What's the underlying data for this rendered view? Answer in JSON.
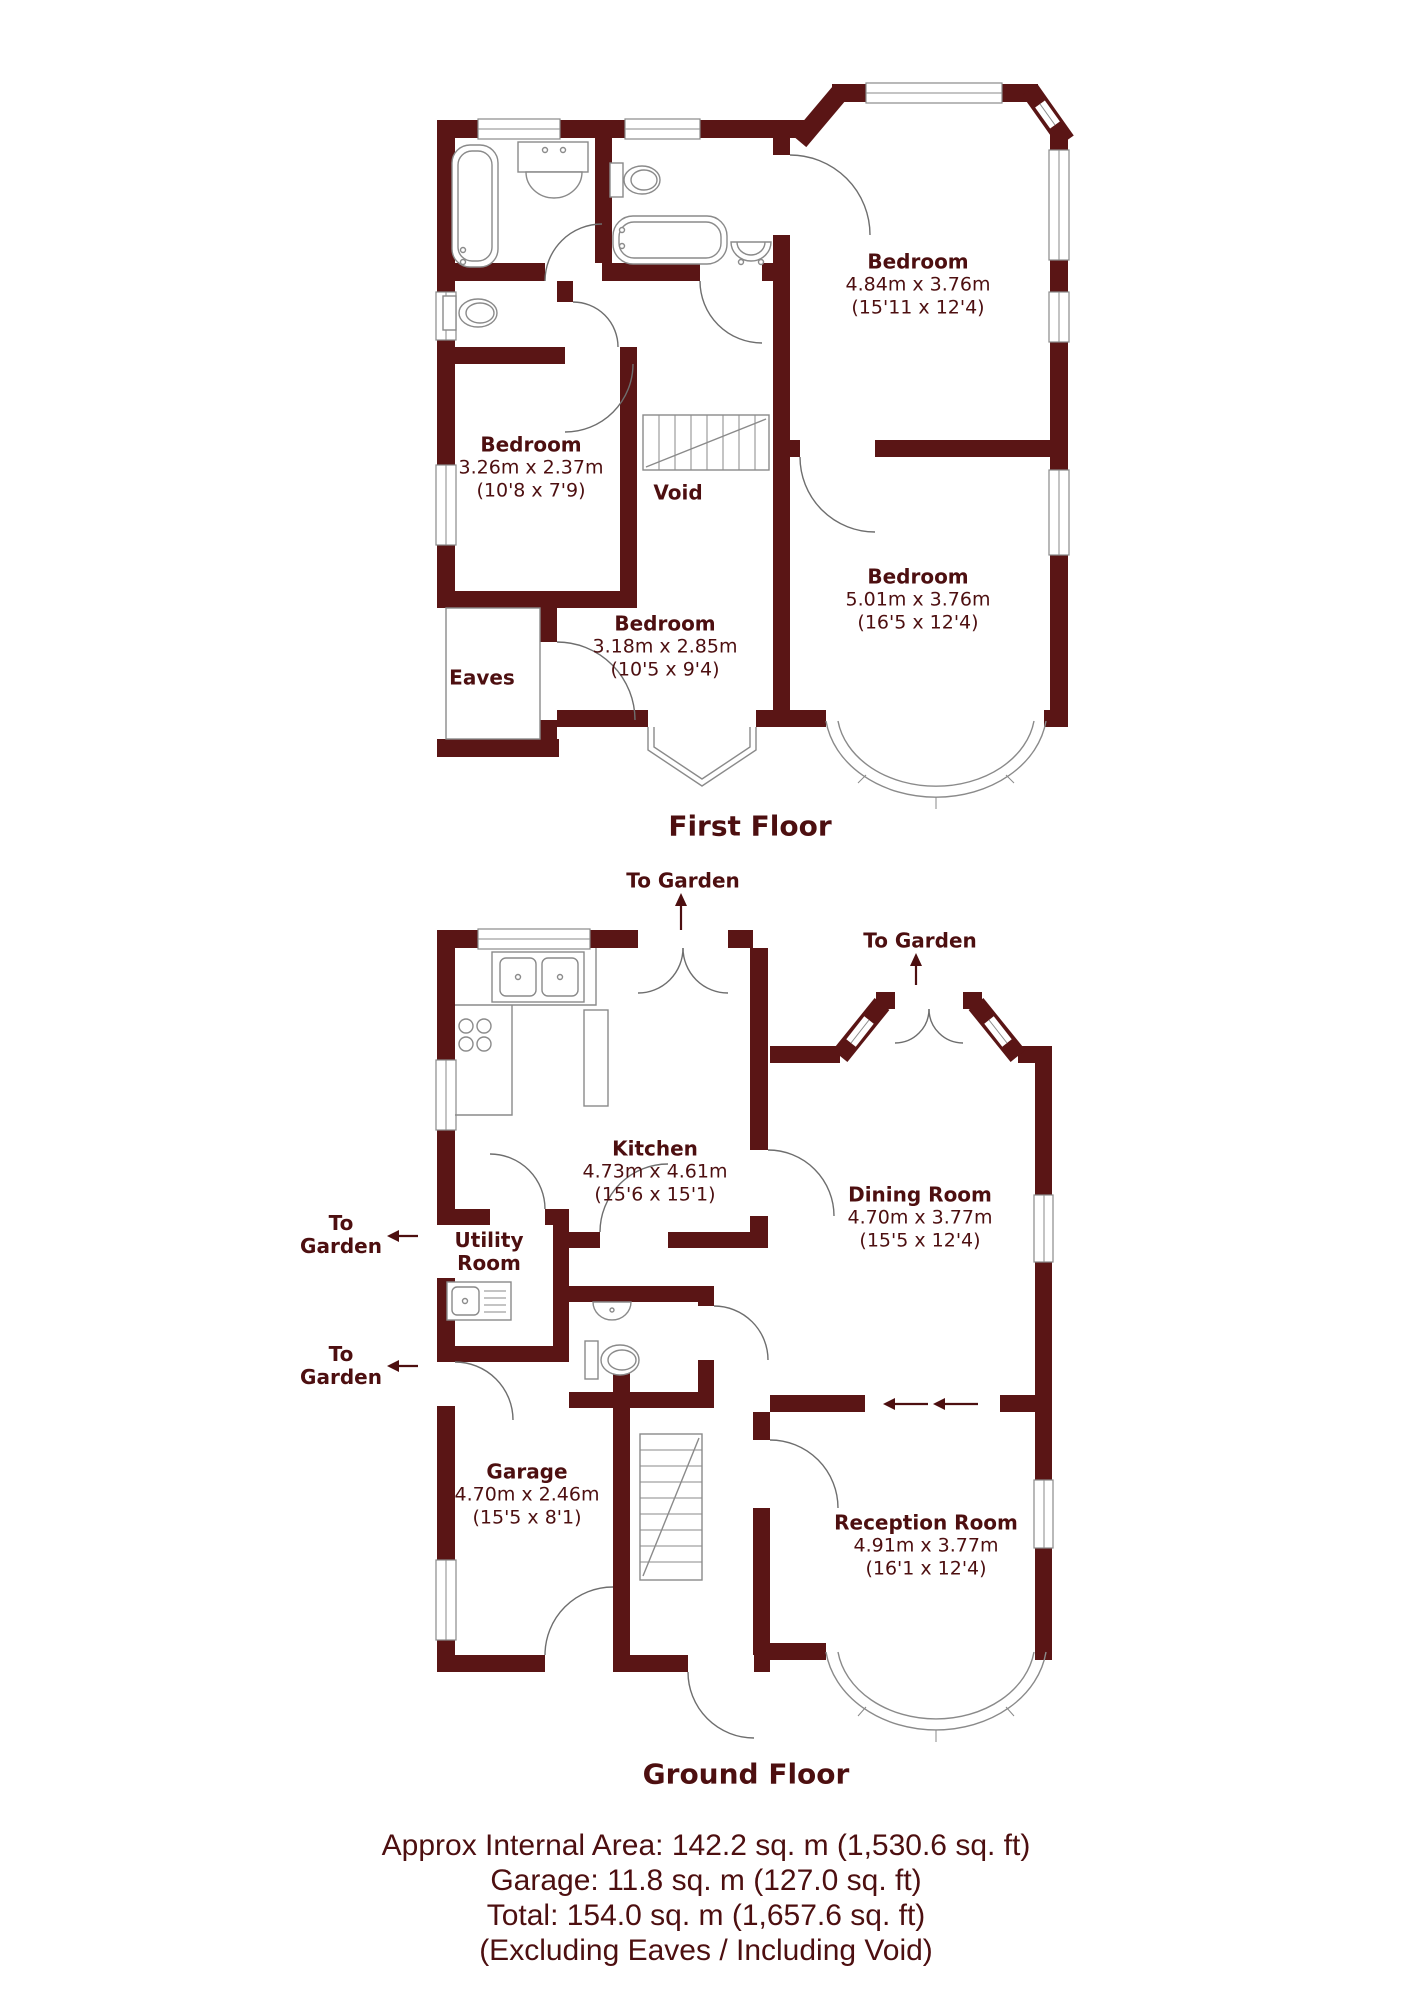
{
  "colors": {
    "wall": "#5a1515",
    "line": "#8a8a8a",
    "text": "#4d0f10"
  },
  "first_floor": {
    "title": "First Floor",
    "rooms": {
      "bedroom_1": {
        "name": "Bedroom",
        "metric": "4.84m x 3.76m",
        "imperial": "(15'11 x 12'4)"
      },
      "bedroom_2": {
        "name": "Bedroom",
        "metric": "3.26m x 2.37m",
        "imperial": "(10'8 x 7'9)"
      },
      "bedroom_3": {
        "name": "Bedroom",
        "metric": "5.01m x 3.76m",
        "imperial": "(16'5 x 12'4)"
      },
      "bedroom_4": {
        "name": "Bedroom",
        "metric": "3.18m x 2.85m",
        "imperial": "(10'5 x 9'4)"
      },
      "void": {
        "name": "Void"
      },
      "eaves": {
        "name": "Eaves"
      }
    }
  },
  "ground_floor": {
    "title": "Ground Floor",
    "rooms": {
      "kitchen": {
        "name": "Kitchen",
        "metric": "4.73m x 4.61m",
        "imperial": "(15'6 x 15'1)"
      },
      "dining": {
        "name": "Dining Room",
        "metric": "4.70m x 3.77m",
        "imperial": "(15'5 x 12'4)"
      },
      "utility": {
        "name_line1": "Utility",
        "name_line2": "Room"
      },
      "garage": {
        "name": "Garage",
        "metric": "4.70m x 2.46m",
        "imperial": "(15'5 x 8'1)"
      },
      "reception": {
        "name": "Reception Room",
        "metric": "4.91m x 3.77m",
        "imperial": "(16'1 x 12'4)"
      }
    },
    "annotations": {
      "to_garden_top": "To Garden",
      "to_garden_dining": "To Garden",
      "to_garden_utility_line1": "To",
      "to_garden_utility_line2": "Garden",
      "to_garden_garage_line1": "To",
      "to_garden_garage_line2": "Garden"
    }
  },
  "footer": {
    "line1": "Approx Internal Area: 142.2 sq. m (1,530.6 sq. ft)",
    "line2": "Garage: 11.8 sq. m (127.0 sq. ft)",
    "line3": "Total: 154.0 sq. m (1,657.6 sq. ft)",
    "line4": "(Excluding Eaves / Including Void)"
  }
}
